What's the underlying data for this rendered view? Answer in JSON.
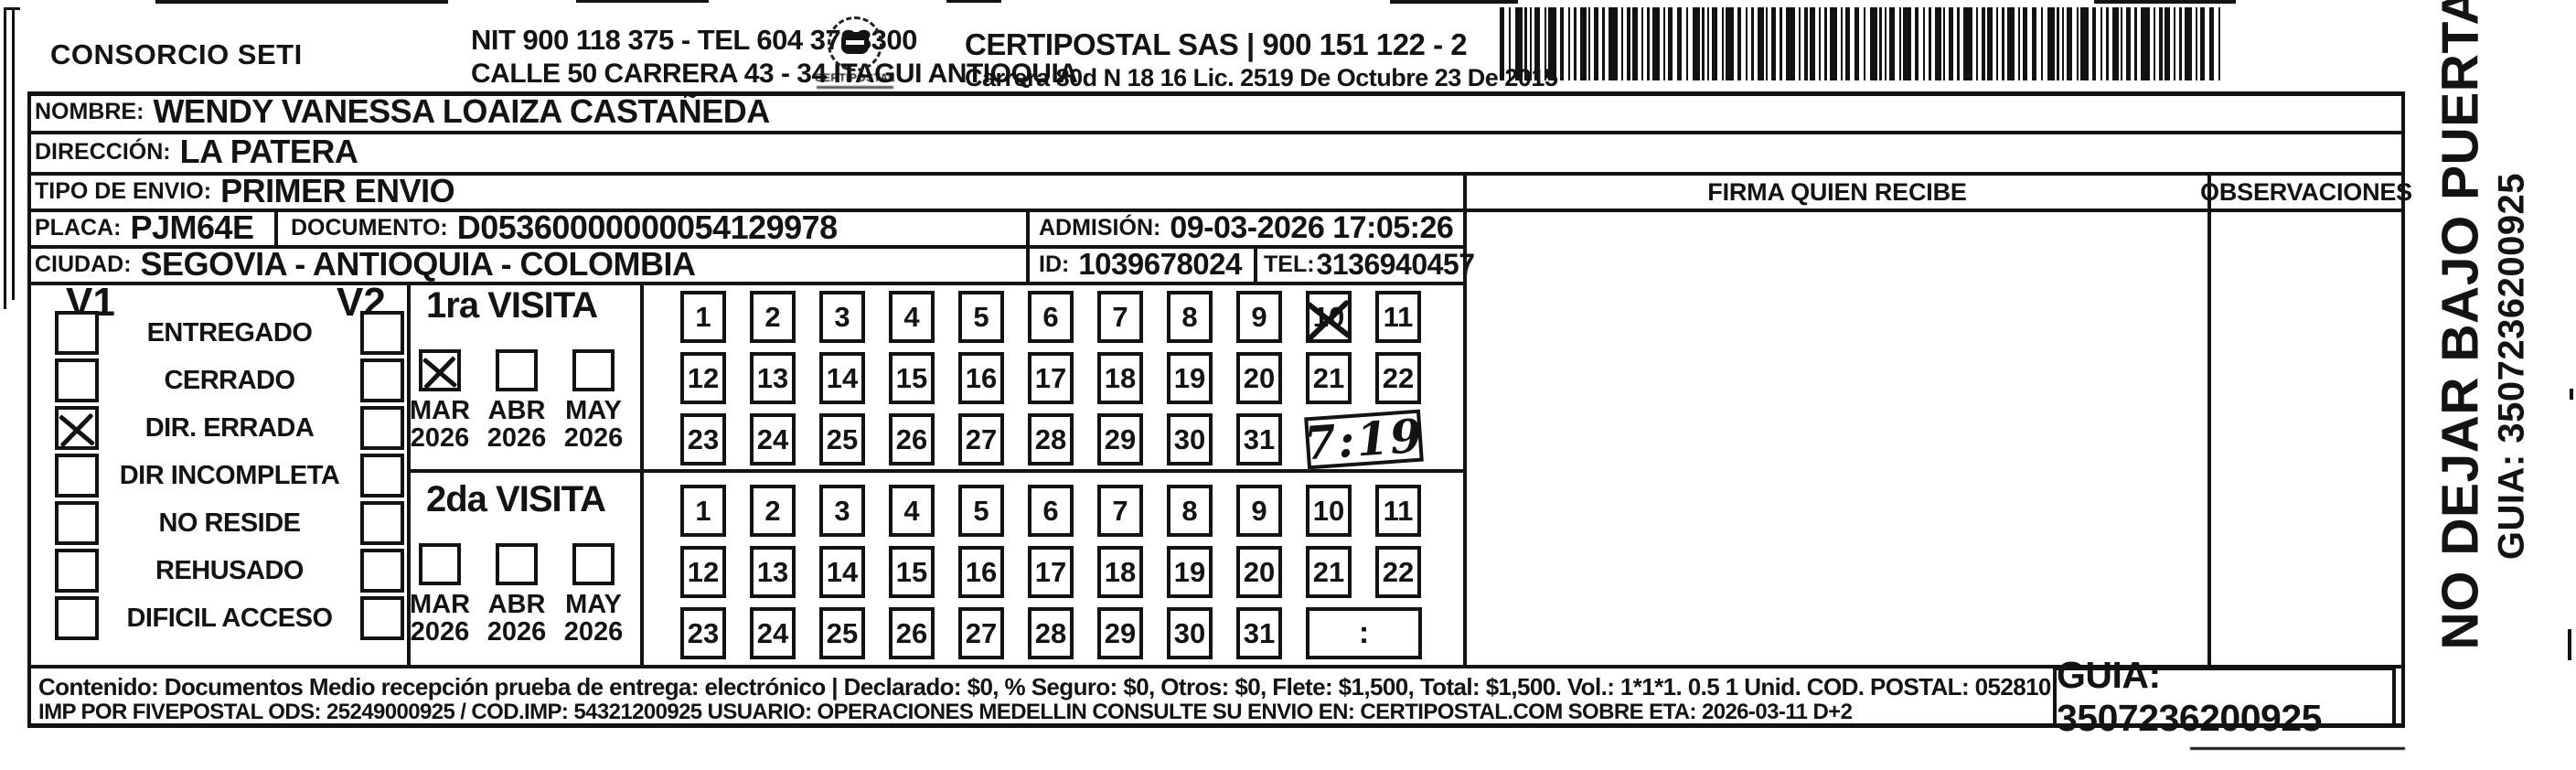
{
  "header": {
    "company_name": "CONSORCIO SETI",
    "nit_tel_line": "NIT 900 118 375 - TEL 604 3723300",
    "address_line": "CALLE 50 CARRERA 43 - 34 ITAGUI ANTIOQUIA",
    "logo_caption": "CERTIPOSTAL",
    "brand_name_line": "CERTIPOSTAL SAS | 900 151 122 - 2",
    "brand_address_line": "Carrera 80d N 18 16  Lic. 2519 De Octubre 23 De 2015"
  },
  "shipment": {
    "nombre_label": "NOMBRE:",
    "nombre_value": "WENDY VANESSA LOAIZA CASTAÑEDA",
    "direccion_label": "DIRECCIÓN:",
    "direccion_value": "LA PATERA",
    "tipo_envio_label": "TIPO DE ENVIO:",
    "tipo_envio_value": "PRIMER ENVIO",
    "placa_label": "PLACA:",
    "placa_value": "PJM64E",
    "documento_label": "DOCUMENTO:",
    "documento_value": "D05360000000054129978",
    "admision_label": "ADMISIÓN:",
    "admision_value": "09-03-2026 17:05:26",
    "ciudad_label": "CIUDAD:",
    "ciudad_value": "SEGOVIA - ANTIOQUIA - COLOMBIA",
    "id_label": "ID:",
    "id_value": "1039678024",
    "tel_label": "TEL:",
    "tel_value": "3136940457"
  },
  "columns": {
    "firma_header": "FIRMA QUIEN RECIBE",
    "observaciones_header": "OBSERVACIONES"
  },
  "status_panel": {
    "v1_header": "V1",
    "v2_header": "V2",
    "items": [
      {
        "label": "ENTREGADO",
        "v1_checked": false,
        "v2_checked": false
      },
      {
        "label": "CERRADO",
        "v1_checked": false,
        "v2_checked": false
      },
      {
        "label": "DIR. ERRADA",
        "v1_checked": true,
        "v2_checked": false
      },
      {
        "label": "DIR INCOMPLETA",
        "v1_checked": false,
        "v2_checked": false
      },
      {
        "label": "NO RESIDE",
        "v1_checked": false,
        "v2_checked": false
      },
      {
        "label": "REHUSADO",
        "v1_checked": false,
        "v2_checked": false
      },
      {
        "label": "DIFICIL ACCESO",
        "v1_checked": false,
        "v2_checked": false
      }
    ]
  },
  "visits": [
    {
      "title": "1ra VISITA",
      "months": [
        {
          "label": "MAR",
          "year": "2026",
          "checked": true
        },
        {
          "label": "ABR",
          "year": "2026",
          "checked": false
        },
        {
          "label": "MAY",
          "year": "2026",
          "checked": false
        }
      ],
      "day_rows": [
        [
          1,
          2,
          3,
          4,
          5,
          6,
          7,
          8,
          9,
          10,
          11
        ],
        [
          12,
          13,
          14,
          15,
          16,
          17,
          18,
          19,
          20,
          21,
          22
        ],
        [
          23,
          24,
          25,
          26,
          27,
          28,
          29,
          30,
          31
        ]
      ],
      "crossed_day": 10,
      "time_value": "7:19",
      "time_handwritten": true
    },
    {
      "title": "2da VISITA",
      "months": [
        {
          "label": "MAR",
          "year": "2026",
          "checked": false
        },
        {
          "label": "ABR",
          "year": "2026",
          "checked": false
        },
        {
          "label": "MAY",
          "year": "2026",
          "checked": false
        }
      ],
      "day_rows": [
        [
          1,
          2,
          3,
          4,
          5,
          6,
          7,
          8,
          9,
          10,
          11
        ],
        [
          12,
          13,
          14,
          15,
          16,
          17,
          18,
          19,
          20,
          21,
          22
        ],
        [
          23,
          24,
          25,
          26,
          27,
          28,
          29,
          30,
          31
        ]
      ],
      "crossed_day": null,
      "time_value": ":",
      "time_handwritten": false
    }
  ],
  "side_note": {
    "warning": "NO DEJAR BAJO PUERTA",
    "guia": "GUIA: 3507236200925"
  },
  "footer": {
    "content_line": "Contenido: Documentos Medio recepción prueba de entrega: electrónico | Declarado: $0, % Seguro: $0, Otros: $0, Flete: $1,500, Total: $1,500. Vol.: 1*1*1. 0.5  1 Unid. COD. POSTAL: 052810",
    "imp_line": "IMP POR FIVEPOSTAL ODS: 25249000925 / COD.IMP: 54321200925 USUARIO: OPERACIONES MEDELLIN CONSULTE SU ENVIO EN: CERTIPOSTAL.COM SOBRE ETA: 2026-03-11 D+2",
    "guia_box": "GUIA: 3507236200925"
  },
  "colors": {
    "ink": "#131313",
    "paper": "#ffffff"
  }
}
